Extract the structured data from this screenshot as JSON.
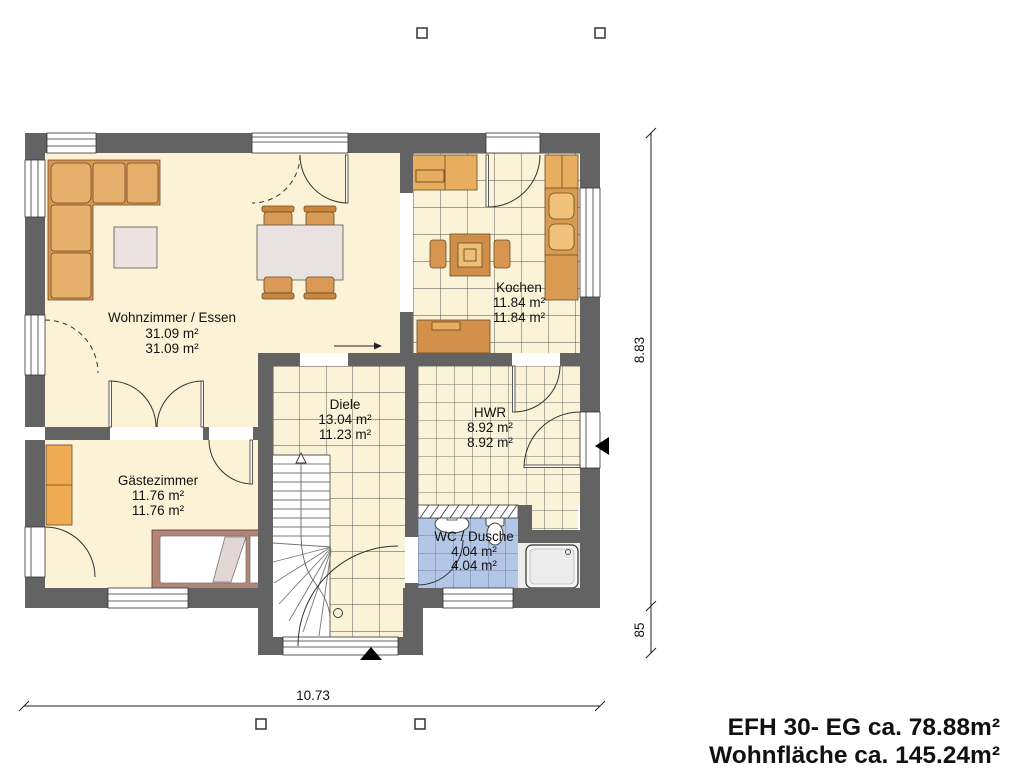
{
  "plan": {
    "rooms": [
      {
        "name": "Wohnzimmer / Essen",
        "area_line1": "31.09 m²",
        "area_line2": "31.09 m²"
      },
      {
        "name": "Kochen",
        "area_line1": "11.84 m²",
        "area_line2": "11.84 m²"
      },
      {
        "name": "Diele",
        "area_line1": "13.04 m²",
        "area_line2": "11.23 m²"
      },
      {
        "name": "HWR",
        "area_line1": "8.92 m²",
        "area_line2": "8.92 m²"
      },
      {
        "name": "Gästezimmer",
        "area_line1": "11.76 m²",
        "area_line2": "11.76 m²"
      },
      {
        "name": "WC / Dusche",
        "area_line1": "4.04 m²",
        "area_line2": "4.04 m²"
      }
    ],
    "dimensions": {
      "height_total": "8.83",
      "height_lower": "85",
      "width_total": "10.73"
    },
    "title_line1": "EFH 30- EG ca. 78.88m²",
    "title_line2": "Wohnfläche ca. 145.24m²",
    "colors": {
      "wall": "#636363",
      "floor_cream": "#fcf2d6",
      "floor_tiled": "#faf3d8",
      "floor_wet_blue": "#b3c6e5",
      "furniture_orange": "#d79551",
      "furniture_light": "#e5b06b",
      "bed_frame": "#b28577",
      "table_gray": "#eae2e0"
    }
  }
}
